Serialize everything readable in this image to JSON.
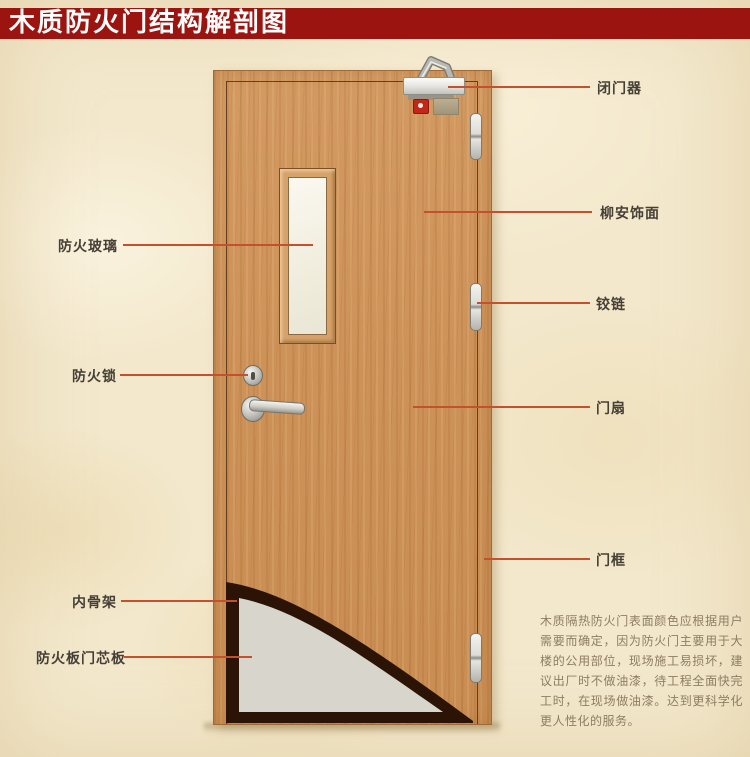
{
  "title": {
    "text": "木质防火门结构解剖图"
  },
  "callouts": {
    "left": [
      {
        "text": "防火玻璃"
      },
      {
        "text": "防火锁"
      },
      {
        "text": "内骨架"
      },
      {
        "text": "防火板门芯板"
      }
    ],
    "right": [
      {
        "text": "闭门器"
      },
      {
        "text": "柳安饰面"
      },
      {
        "text": "铰链"
      },
      {
        "text": "门扇"
      },
      {
        "text": "门框"
      }
    ]
  },
  "note": {
    "text": "木质隔热防火门表面颜色应根据用户需要而确定，因为防火门主要用于大楼的公用部位，现场施工易损坏，建议出厂时不做油漆，待工程全面快完工时，在现场做油漆。达到更科学化更人性化的服务。"
  },
  "illustration_parts": [
    "door-closer",
    "alarm-indicator",
    "hinge-top",
    "hinge-middle",
    "hinge-bottom",
    "fire-glass-window",
    "lock-cylinder",
    "door-handle",
    "cutaway-core",
    "cutaway-skeleton"
  ],
  "colors": {
    "banner_bg": "#9c1410",
    "banner_text": "#ffffff",
    "leader_line": "#c3512d",
    "label_text": "#453f36",
    "note_text": "#8d7d61",
    "wood": "#cd9258",
    "glass": "#f3f0e2",
    "core_gray": "#d8d6cc",
    "skeleton_dark": "#2b1406",
    "background": "#f3e8cc"
  }
}
